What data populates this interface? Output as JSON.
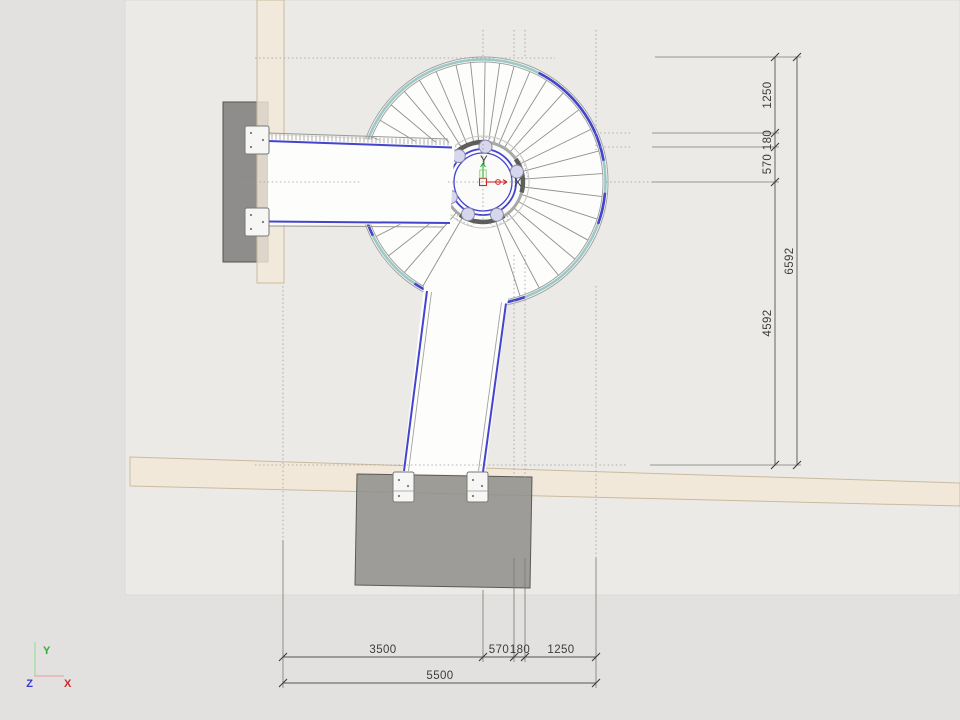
{
  "app": {
    "description": "CAD plan view of a spiral staircase with two landings and dimension chains"
  },
  "dims_right": {
    "segments": [
      "1250",
      "180",
      "570",
      "4592"
    ],
    "total": "6592"
  },
  "dims_bottom": {
    "segments": [
      "3500",
      "570",
      "180",
      "1250"
    ],
    "total": "5500"
  },
  "origin_gizmo": {
    "x_label": "X",
    "y_label": "Y"
  },
  "view_gizmo": {
    "x_label": "X",
    "y_label": "Y",
    "z_label": "Z"
  },
  "colors": {
    "accent_blue": "#4444cf",
    "rail_teal": "#9cc8c6",
    "wall_beige": "#f1e8d9",
    "slab_gray": "#8f8e8a",
    "background": "#e4e3e0",
    "floor_panel": "#eceae7",
    "axis_red": "#cc2a2a",
    "axis_green": "#2db030",
    "axis_blue": "#3a3ad0"
  }
}
